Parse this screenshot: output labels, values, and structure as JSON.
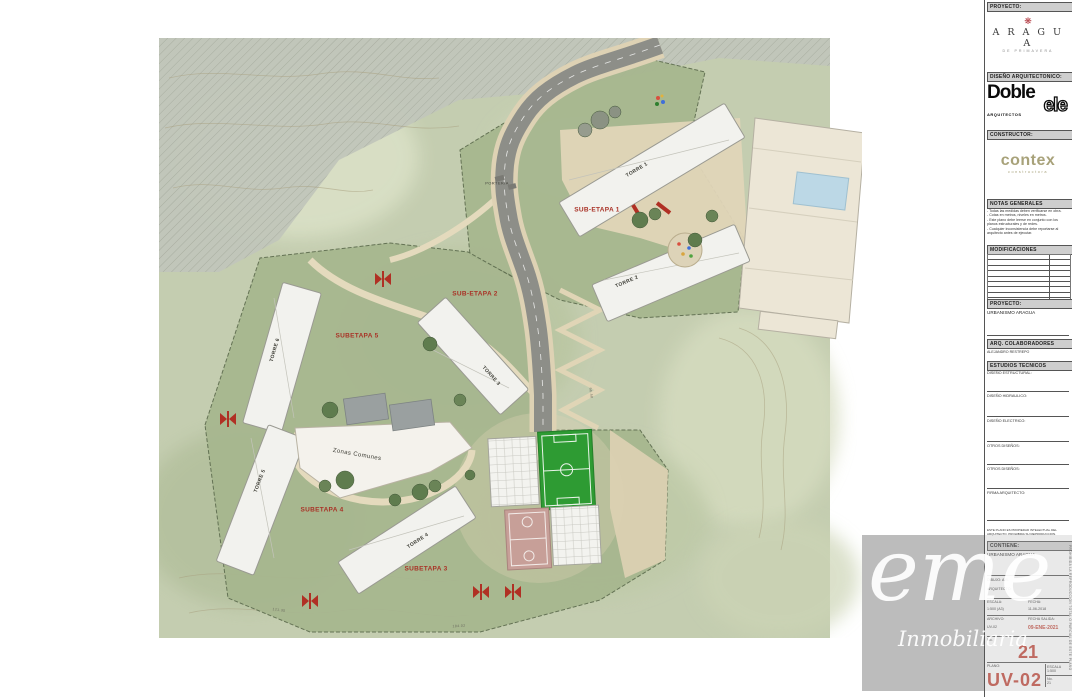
{
  "plan": {
    "labels": {
      "torre1": "TORRE 1",
      "torre2": "TORRE 2",
      "torre3": "TORRE 3",
      "torre4": "TORRE 4",
      "torre5": "TORRE 5",
      "torre6": "TORRE 6",
      "subetapa1": "SUB-ETAPA 1",
      "subetapa2": "SUB-ETAPA 2",
      "subetapa3": "SUBETAPA 3",
      "subetapa4": "SUBETAPA 4",
      "subetapa5": "SUBETAPA 5",
      "zonas_comunes": "Zonas Comunes",
      "porteria": "PORTERIA",
      "dim1": "121.35",
      "dim2": "184.02",
      "dim3": "96.40"
    }
  },
  "titleblock": {
    "top_header": "PROYECTO:",
    "aragua": {
      "ornament": "❋",
      "name": "A R A G U A",
      "tagline": "DE PRIMAVERA"
    },
    "design_header": "DISEÑO ARQUITECTONICO:",
    "dobleele": {
      "line1": "Doble",
      "line2": "ele",
      "sub": "ARQUITECTOS"
    },
    "builder_header": "CONSTRUCTOR:",
    "contex": {
      "name": "contex",
      "sub": "constructora"
    },
    "notes_header": "NOTAS GENERALES",
    "notes": [
      "- Todas las medidas deben verificarse en obra.",
      "- Cotas en metros, niveles en metros.",
      "- Este plano debe leerse en conjunto con los planos estructurales y de redes.",
      "- Cualquier inconsistencia debe reportarse al arquitecto antes de ejecutar."
    ],
    "modifications_header": "MODIFICACIONES",
    "project_header": "PROYECTO:",
    "project_name": "URBANISMO ARAGUA",
    "collaborators_header": "ARQ. COLABORADORES",
    "collaborator": "ALEJANDRO RESTREPO",
    "studies_header": "ESTUDIOS TECNICOS",
    "study_rows": [
      "DISEÑO ESTRUCTURAL:",
      "DISEÑO HIDRAULICO:",
      "DISEÑO ELECTRICO:",
      "OTROS DISEÑOS:",
      "OTROS DISEÑOS:",
      "FIRMA ARQUITECTO:"
    ],
    "disclaimer": "ESTE PLANO ES PROPIEDAD INTELECTUAL DEL ARQUITECTO. PROHIBIDA SU REPRODUCCION.",
    "contains_header": "CONTIENE:",
    "contains_value": "URBANISMO ARAGUA",
    "dibujo_label": "DIBUJO:",
    "dibujo_value": "A.B.",
    "arquitecto_label": "ARQUITECTO:",
    "escala_label": "ESCALA:",
    "escala_value": "1:500 (A3)",
    "fecha_label": "FECHA:",
    "fecha_value": "11-06-2018",
    "archivo_label": "ARCHIVO:",
    "archivo_value": "UV-02",
    "salida_label": "FECHA SALIDA:",
    "salida_value": "09-ENE-2021",
    "sheet_no_label": "No.",
    "sheet_number": "21",
    "plano_label": "PLANO:",
    "sheet_code": "UV-02",
    "mini": [
      [
        "ESCALA",
        "1:500"
      ],
      [
        "No.",
        "21"
      ]
    ],
    "vertical_note": "PROHIBIDA LA REPRODUCCION TOTAL O PARCIAL DE ESTE PLANO"
  },
  "watermark": {
    "logo": "eme",
    "sub": "Inmobiliaria"
  },
  "colors": {
    "accent_red": "#b03024",
    "label_red": "#a93226",
    "field_green": "#2e9b33",
    "road_gray": "#8d8e88",
    "contex": "#a8a27a",
    "watermark_gray": "#bcbcbc"
  }
}
